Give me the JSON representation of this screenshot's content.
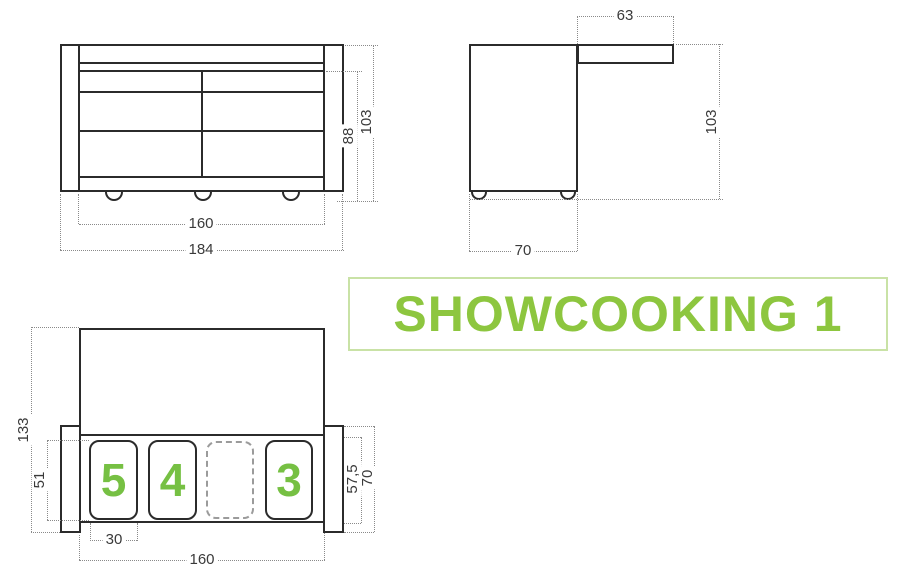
{
  "title": {
    "text": "SHOWCOOKING 1"
  },
  "colors": {
    "accent_green": "#8dc63f",
    "module_green": "#76c043",
    "line_dark": "#2b2b2b",
    "dim_gray": "#8a8a8a"
  },
  "front_view": {
    "inner_width": "160",
    "outer_width": "184",
    "inner_height": "88",
    "outer_height": "103"
  },
  "side_view": {
    "shelf_depth": "63",
    "height": "103",
    "depth": "70"
  },
  "plan_view": {
    "total_depth": "133",
    "opening_depth": "51",
    "module_width": "30",
    "inner_width": "160",
    "counter_depth": "57,5",
    "body_depth": "70",
    "modules": [
      {
        "label": "5"
      },
      {
        "label": "4"
      },
      {
        "label": ""
      },
      {
        "label": "3"
      }
    ]
  }
}
